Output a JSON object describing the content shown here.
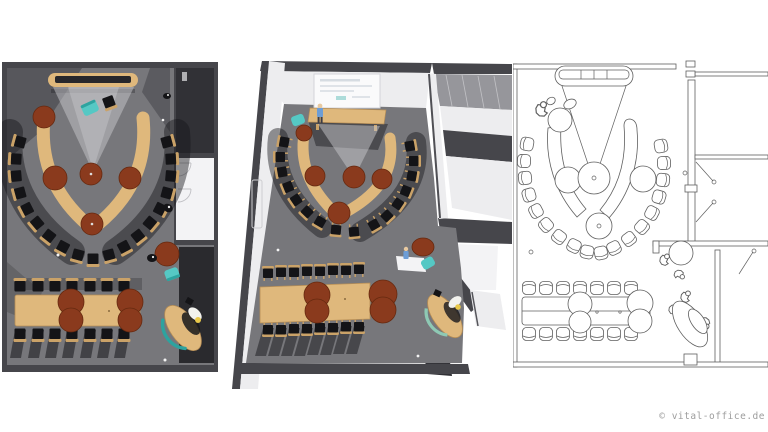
{
  "page": {
    "width": 768,
    "height": 432,
    "background": "#ffffff"
  },
  "footer": {
    "copyright": "© vital-office.de"
  },
  "panels": [
    {
      "id": "top-down-render"
    },
    {
      "id": "perspective-render"
    },
    {
      "id": "line-drawing-plan"
    }
  ],
  "colors": {
    "page_bg": "#ffffff",
    "wall_dark": "#46464b",
    "wall_darker": "#313136",
    "carpet": "#77777b",
    "shadow": "#17171b",
    "wood": "#dfb87c",
    "wood_mid": "#caa268",
    "wood_dark": "#b68d55",
    "rust": "#8a3a1d",
    "rust_dark": "#66290f",
    "cone": "#c7c7cc",
    "white_face": "#ededef",
    "floor_white": "#f3f3f5",
    "screen": "#fafafb",
    "glass": "#96969b",
    "glass_line": "#c2c2c6",
    "teal": "#55c8c4",
    "teal_dark": "#2da39f",
    "accent_green": "#8ec9b4",
    "blue": "#6d9dd6",
    "skin": "#e8c9a0",
    "black": "#141417",
    "sketch": "#5f5f5f",
    "copyright": "#9d9d9d"
  }
}
